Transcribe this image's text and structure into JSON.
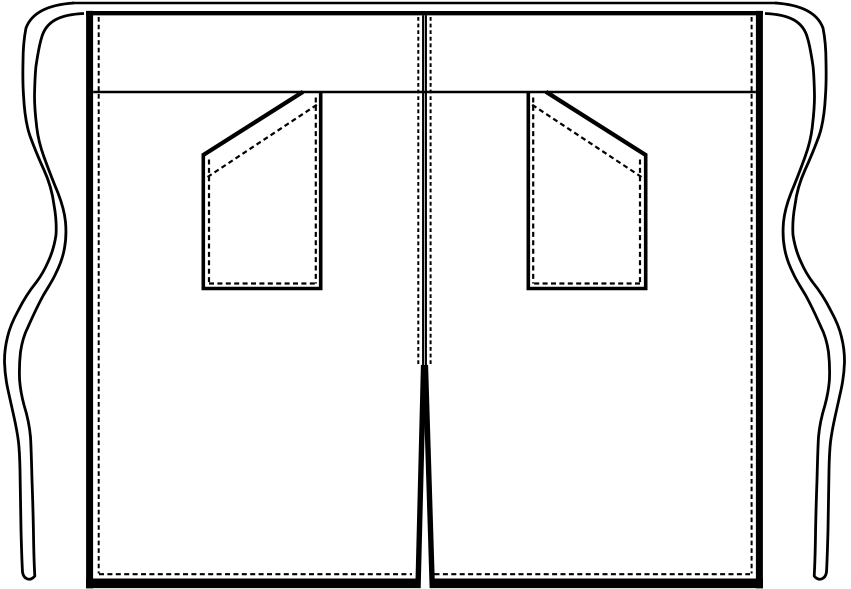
{
  "meta": {
    "title": "Half apron technical flat drawing, front view",
    "artifact": "garment-spec-line-drawing",
    "text_content": "none"
  },
  "colors": {
    "line": "#000000",
    "background": "#ffffff"
  },
  "strokes": {
    "side_edge": 7,
    "hem_edge": 9.6,
    "waistband_top": 4.4,
    "tie_outline": 2.8,
    "waist_seam": 2.6,
    "pocket_edge": 3.6,
    "pocket_opening": 4.2,
    "stitch": 2.2,
    "vent_leg": 5.4
  },
  "dashes": {
    "edge_stitch": "4.6 3.1",
    "pocket_stitch": "5 3.4",
    "center_front_stitch": "3.8 2.8"
  },
  "parts": {
    "tie_left": "waist-tie-left",
    "tie_right": "waist-tie-right",
    "tie_top_edge": "tie-top-edge",
    "waistband": "waistband-top-edge",
    "waist_seam": "waistband-seam",
    "body_left": "apron-side-edge-left",
    "body_right": "apron-side-edge-right",
    "hem": "apron-hem-edge",
    "pocket_left": "pocket-left",
    "pocket_right": "pocket-right",
    "center_front": "center-front-overlap-line",
    "vent": "center-hem-vent",
    "stitching": "topstitch-dashed-lines"
  }
}
